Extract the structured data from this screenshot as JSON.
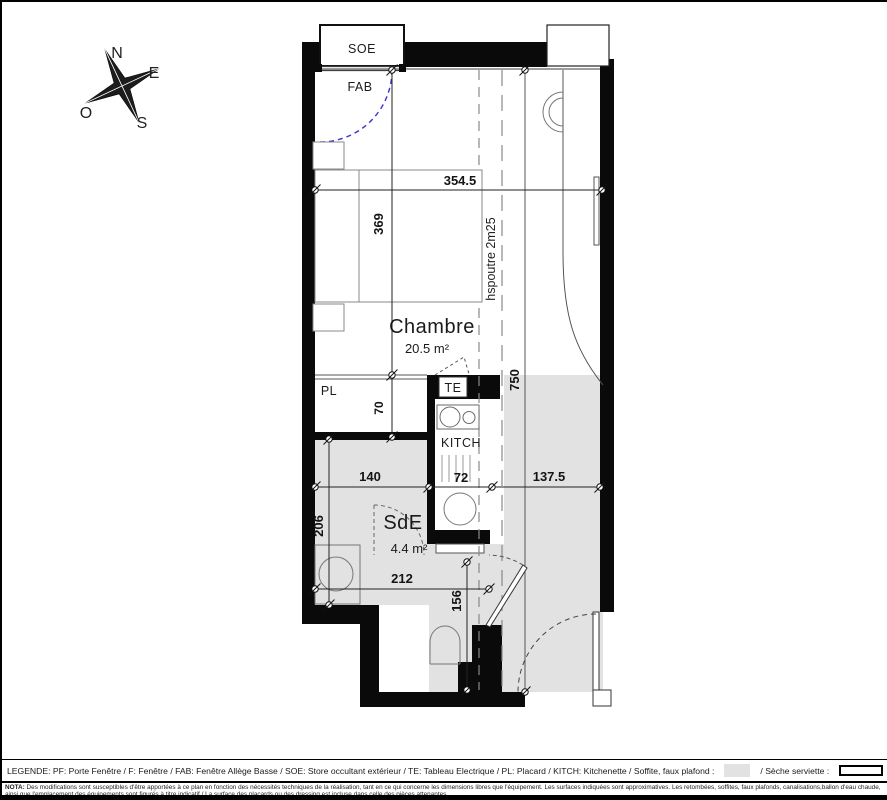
{
  "compass": {
    "north": "N",
    "east": "E",
    "south": "S",
    "west": "O"
  },
  "plan": {
    "window_box_label": "SOE",
    "window_label": "FAB",
    "rooms": {
      "chambre": {
        "name": "Chambre",
        "area": "20.5 m²"
      },
      "sde": {
        "name": "SdE",
        "area": "4.4 m²"
      }
    },
    "labels": {
      "placard": "PL",
      "tableau_electrique": "TE",
      "kitchenette": "KITCH"
    },
    "beam_note": "hspoutre 2m25",
    "dimensions": {
      "chambre_width": "354.5",
      "chambre_depth": "369",
      "placard_depth": "70",
      "total_depth": "750",
      "sde_width": "140",
      "kitchen_width": "72",
      "entry_width": "137.5",
      "sde_depth": "206",
      "lower_width": "212",
      "wc_depth": "156"
    }
  },
  "legend": {
    "main_text": "LEGENDE: PF: Porte Fenêtre / F: Fenêtre / FAB: Fenêtre Allège Basse / SOE: Store occultant extérieur / TE: Tableau Electrique / PL: Placard / KITCH: Kitchenette / Soffite, faux plafond :",
    "seche_label": "/ Sèche serviette :"
  },
  "nota": {
    "label": "NOTA:",
    "line1": "Des modifications sont susceptibles d'être apportées à ce plan en fonction des nécessités techniques de la réalisation, tant en ce qui concerne les dimensions libres que l'équipement. Les surfaces indiquées sont approximatives. Les retombées, soffites, faux plafonds, canalisations,ballon d'eau chaude,",
    "line2": "ainsi que l'emplacement des équipements sont figurés à titre indicatif / La surface des placards ou des dressing est incluse dans celle des pièces attenantes."
  },
  "colors": {
    "wall": "#000000",
    "soffit_gray": "#e2e2e2",
    "window_arc_blue": "#3535cf"
  }
}
